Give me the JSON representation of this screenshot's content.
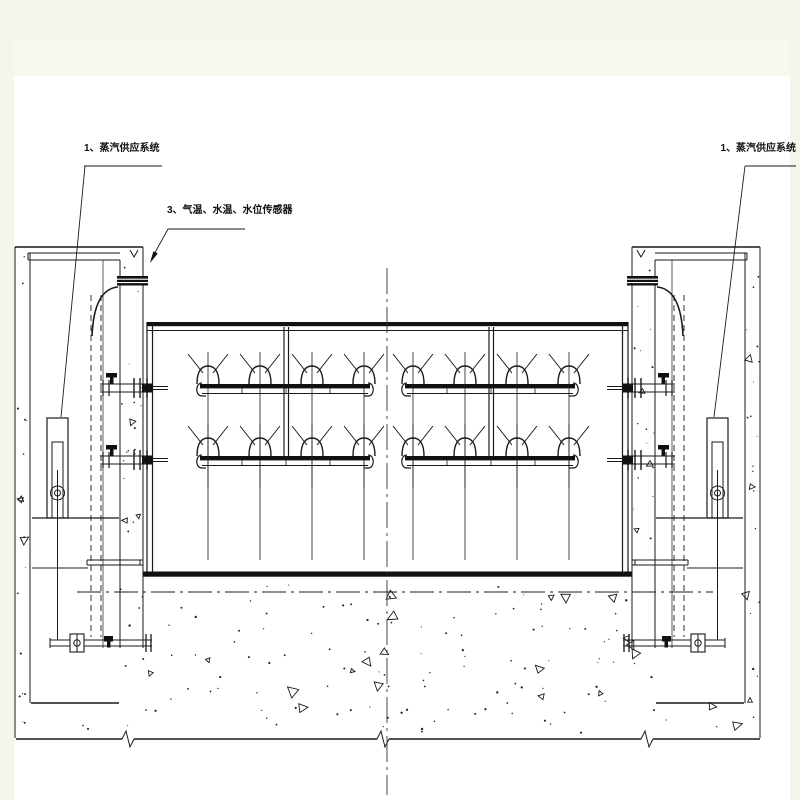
{
  "drawing": {
    "labels": {
      "left_system": "1、蒸汽供应系统",
      "sensors": "3、气温、水温、水位传感器",
      "right_system": "1、蒸汽供应系统"
    },
    "colors": {
      "line": "#1a1a1a",
      "paper": "#ffffff",
      "margin": "#f4f6ec"
    }
  }
}
